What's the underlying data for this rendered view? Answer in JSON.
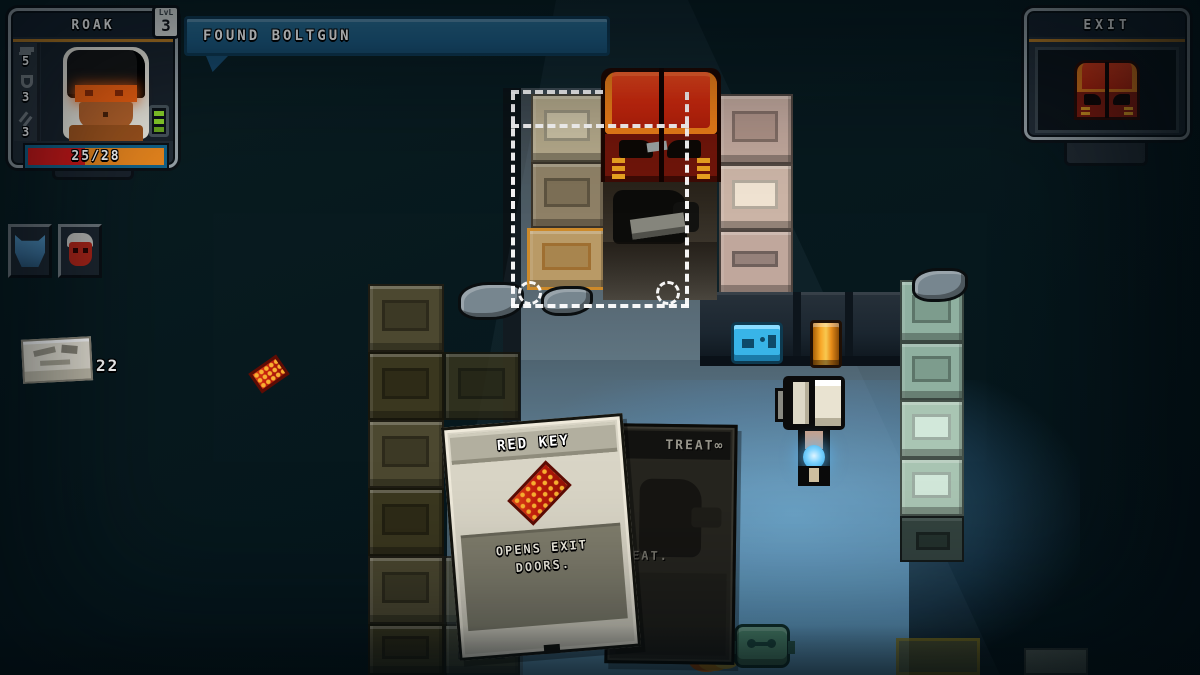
{
  "hud": {
    "character": {
      "name": "ROAK",
      "level_label": "LvL",
      "level": "3",
      "stats": [
        {
          "name": "attack",
          "value": "5"
        },
        {
          "name": "armor",
          "value": "3"
        },
        {
          "name": "melee",
          "value": "3"
        }
      ],
      "health": "25/28"
    },
    "notification": {
      "text": "FOUND BOLTGUN"
    },
    "exit_panel": {
      "title": "EXIT"
    },
    "inventory": {
      "ammo_count": "22"
    }
  },
  "cards": {
    "red_key": {
      "title": "RED KEY",
      "description": "OPENS EXIT DOORS."
    },
    "behind": {
      "title_visible": "TREAT∞",
      "body_visible": "REAT."
    }
  },
  "colors": {
    "accent_orange": "#b87b22",
    "notification_blue": "#1d5a80",
    "health_red": "#d01818",
    "health_orange": "#e8861e",
    "door_red": "#c62410",
    "floor_glow": "#4fa0cf"
  }
}
